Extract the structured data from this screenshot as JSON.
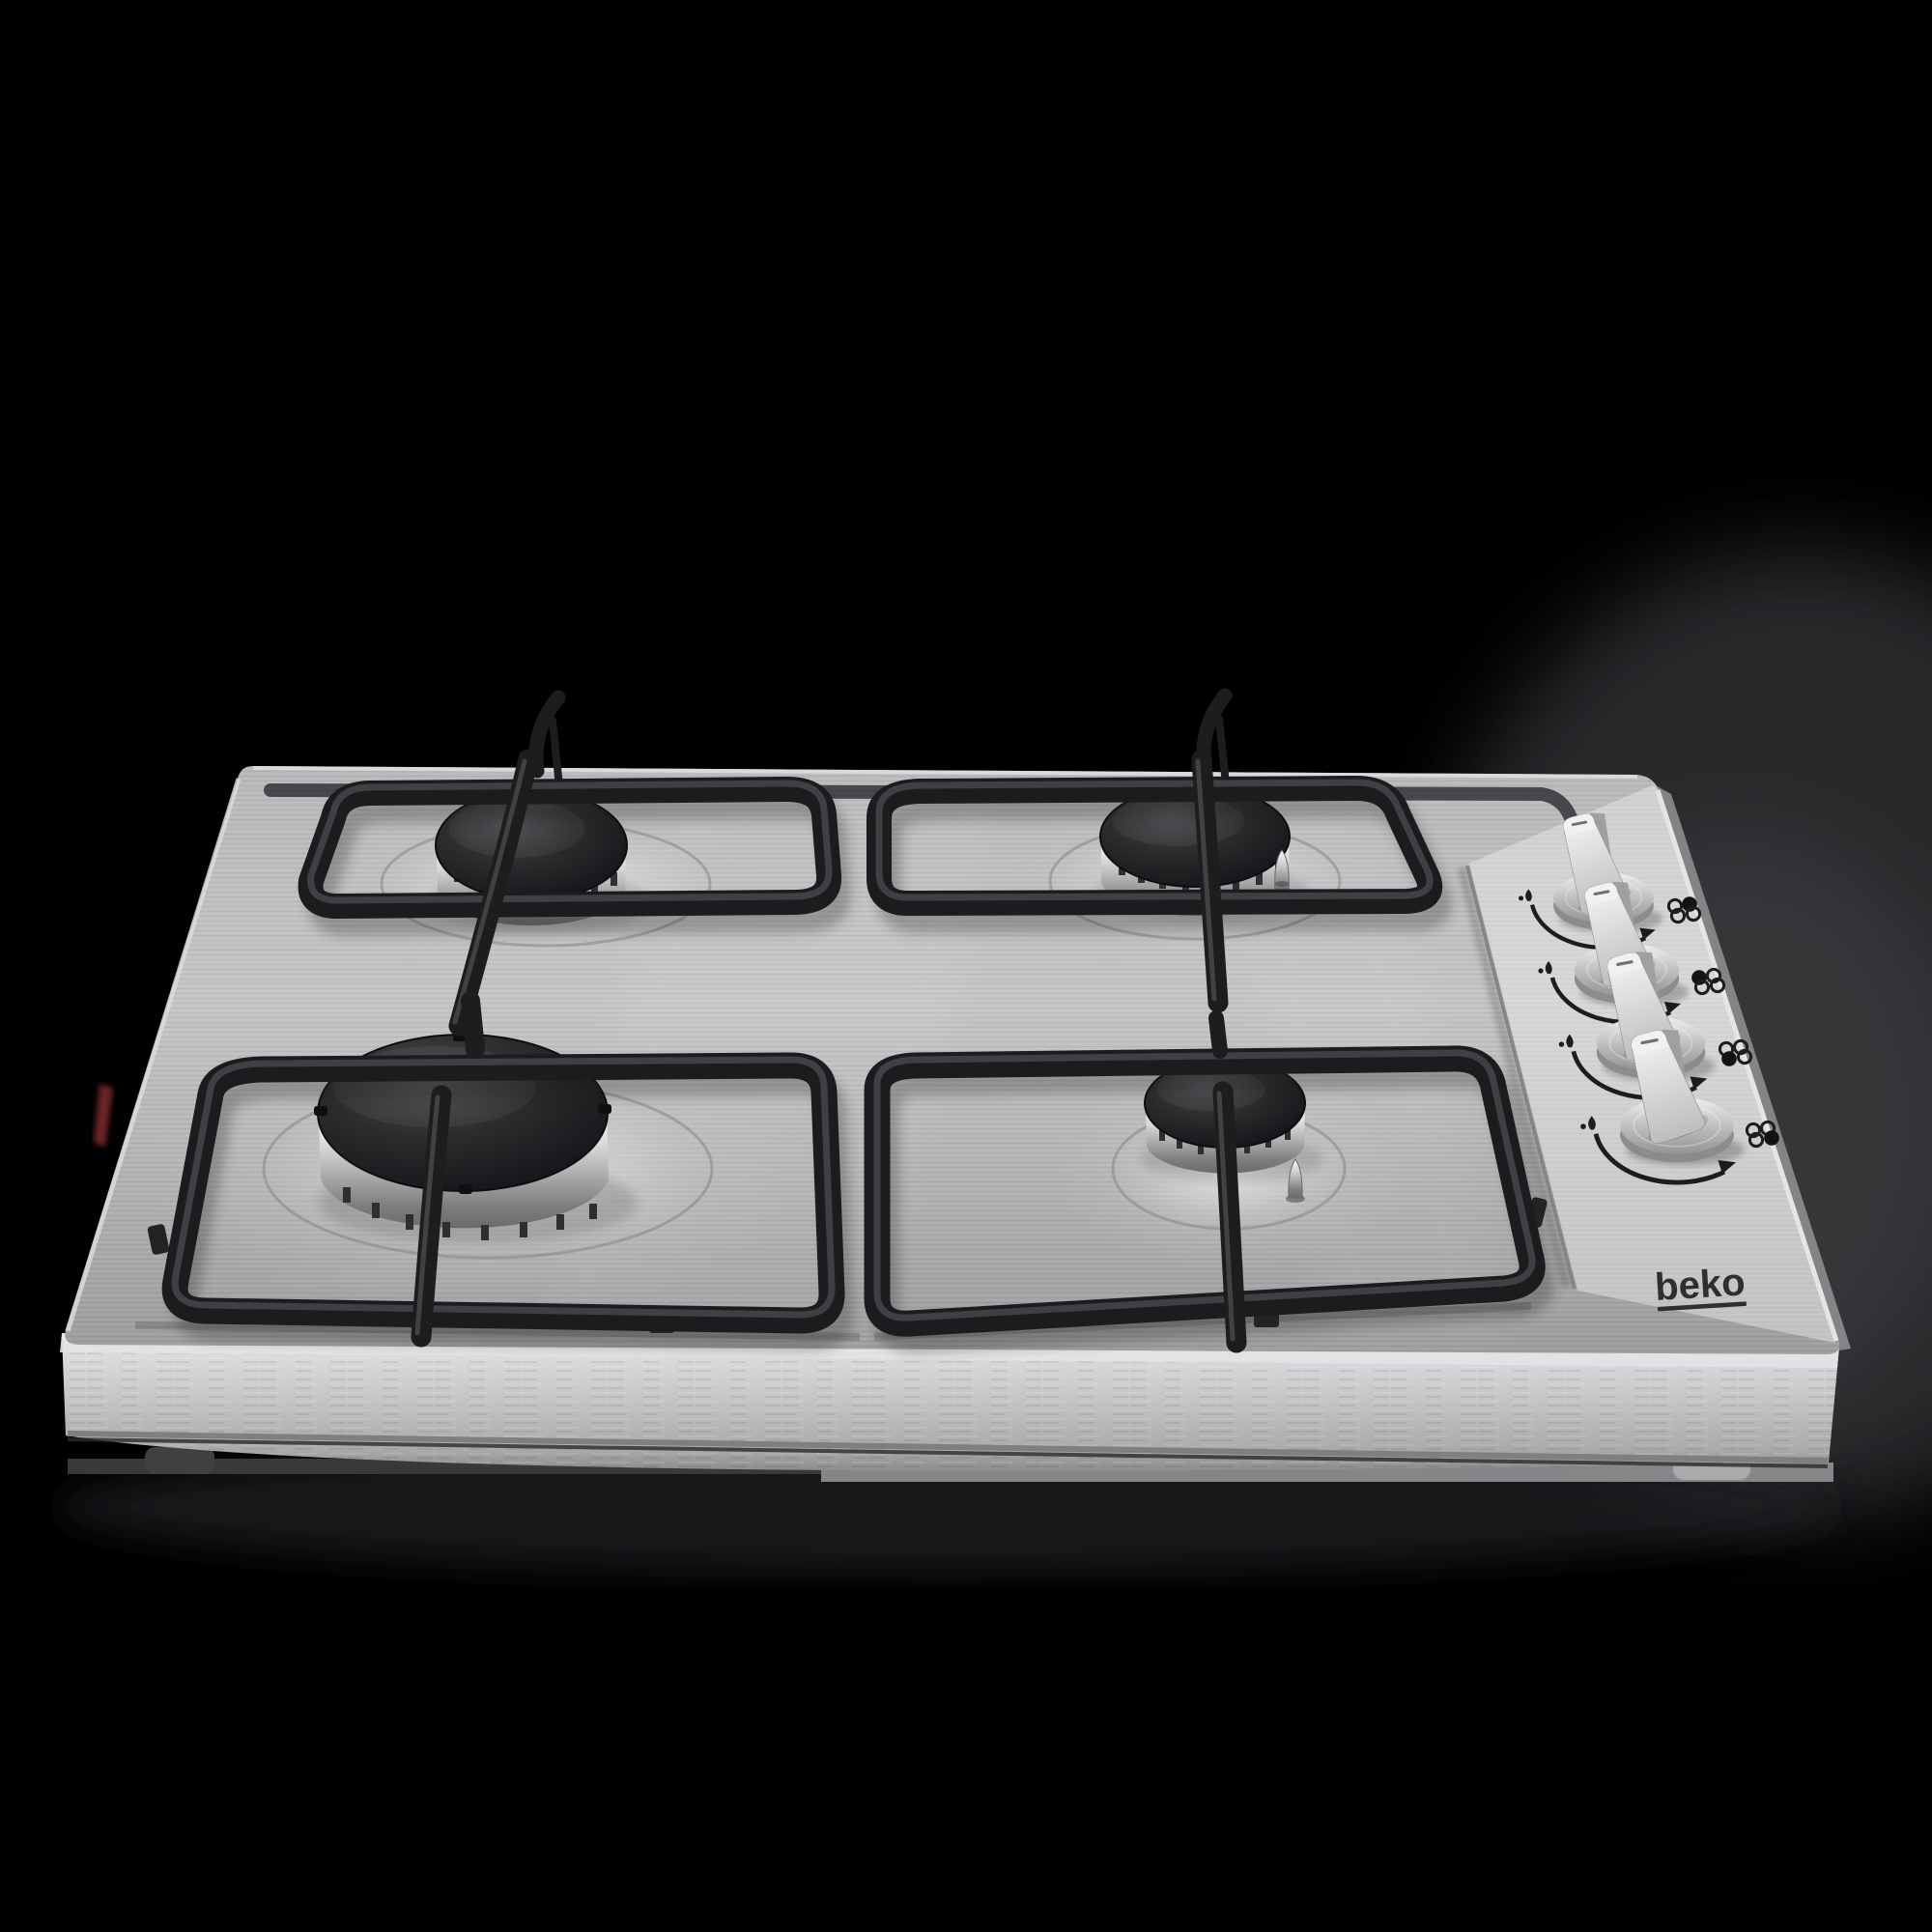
{
  "scene": {
    "type": "product-photo",
    "subject": "Four-burner stainless steel built-in gas hob seen from a low front angle",
    "background": "black studio backdrop with soft grey glow at right"
  },
  "brand": {
    "logo_text": "beko"
  },
  "colors": {
    "background": "#000000",
    "steel-light": "#c6c7c9",
    "steel-mid": "#b0b1b3",
    "steel-dark": "#9b9c9e",
    "side-face": "#c9cacc",
    "burner-cap": "#232427",
    "burner-body-light": "#f2f2f3",
    "grate": "#1b1c1e",
    "marking": "#1c1d1f",
    "knob-metal": "#d8d9db",
    "logo": "#2e2f31",
    "backdrop-glow": "#4a4b4f",
    "red-reflection": "#7e2b2b"
  },
  "burners": [
    {
      "name": "back-left-burner",
      "size": "medium"
    },
    {
      "name": "back-right-burner",
      "size": "medium"
    },
    {
      "name": "front-left-burner",
      "size": "large-rapid"
    },
    {
      "name": "front-right-burner",
      "size": "small-auxiliary"
    }
  ],
  "knobs": [
    {
      "name": "knob-1",
      "row": 1,
      "controls_burner": "back-right",
      "filled_indicator_dot": "top-right",
      "state": "off"
    },
    {
      "name": "knob-2",
      "row": 2,
      "controls_burner": "back-left",
      "filled_indicator_dot": "top-left",
      "state": "off"
    },
    {
      "name": "knob-3",
      "row": 3,
      "controls_burner": "front-left",
      "filled_indicator_dot": "bottom-left",
      "state": "off"
    },
    {
      "name": "knob-4",
      "row": 4,
      "controls_burner": "front-right",
      "filled_indicator_dot": "bottom-right",
      "state": "off"
    }
  ],
  "markings": {
    "dial_arc": "curved arc printed around each knob",
    "flame_symbol": "small flame glyph at the high end of each arc",
    "arrowhead": "small arrowhead at the low end of each arc",
    "indicator_dots": "2x2 dot grid beside each knob; the filled dot marks the burner that knob controls"
  },
  "grates": {
    "count": 4,
    "style": "black enamel pan supports with rounded bars"
  },
  "ignition": {
    "spark_plugs_visible": 2
  }
}
